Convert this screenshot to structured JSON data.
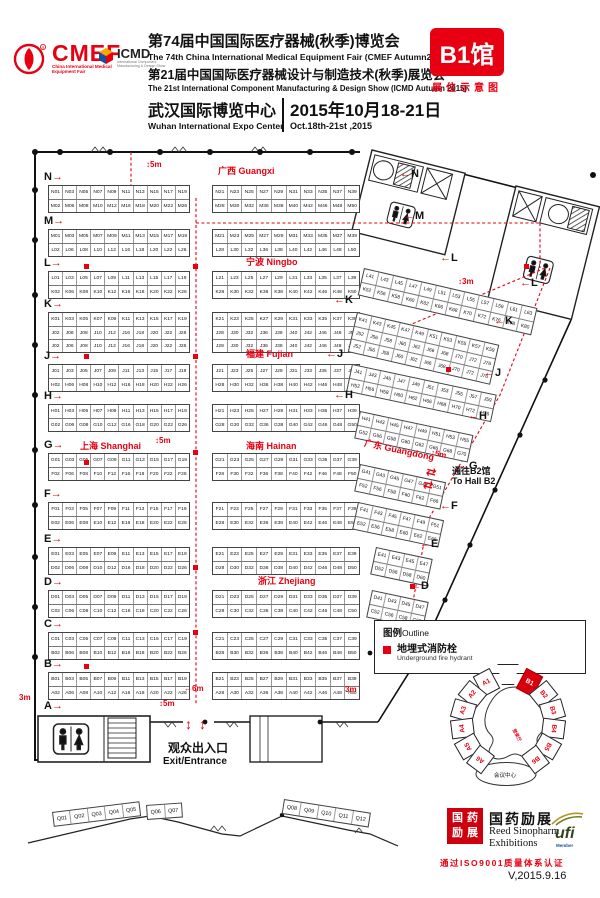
{
  "header": {
    "cmef": {
      "name": "CMEF",
      "tagline": "China International Medical Equipment Fair"
    },
    "icmd": {
      "name": "ICMD",
      "tagline": "International Component Manufacturing & Design Show"
    },
    "title_cn_1": "第74届中国国际医疗器械(秋季)博览会",
    "title_en_1": "The 74th China International Medical Equipment Fair (CMEF Autumn2015)",
    "title_cn_2": "第21届中国国际医疗器械设计与制造技术(秋季)展览会",
    "title_en_2": "The 21st International Component Manufacturing & Design Show (ICMD Autumn 2015)",
    "venue_cn": "武汉国际博览中心",
    "venue_en": "Wuhan International Expo Center",
    "date_cn": "2015年10月18-21日",
    "date_en": "Oct.18th-21st ,2015",
    "hall_badge": "B1馆",
    "hall_badge_sub": "展位示意图"
  },
  "plan": {
    "regions": {
      "guangxi": "广西 Guangxi",
      "ningbo": "宁波 Ningbo",
      "fujian": "福建 Fujian",
      "shanghai": "上海 Shanghai",
      "hainan": "海南 Hainan",
      "zhejiang": "浙江 Zhejiang",
      "guangdong": "广东 Guangdong"
    },
    "row_markers_left": [
      "N",
      "M",
      "L",
      "K",
      "J",
      "H",
      "G",
      "F",
      "E",
      "D",
      "C",
      "B",
      "A"
    ],
    "row_markers_right": [
      "N",
      "M",
      "L",
      "K",
      "J",
      "H"
    ],
    "row_markers_diag": [
      "L",
      "K",
      "J",
      "H",
      "G",
      "F",
      "E",
      "D",
      "C"
    ],
    "dims": [
      {
        "id": "d1",
        "text": "5m"
      },
      {
        "id": "d2",
        "text": "3m"
      },
      {
        "id": "d3",
        "text": "5m"
      },
      {
        "id": "d4",
        "text": "5m"
      },
      {
        "id": "d5",
        "text": "3m"
      },
      {
        "id": "d6",
        "text": "6m"
      },
      {
        "id": "d7",
        "text": "3m"
      },
      {
        "id": "d8",
        "text": "5m"
      },
      {
        "id": "d9",
        "text": "5m"
      }
    ],
    "exit": {
      "cn": "观众出入口",
      "en": "Exit/Entrance"
    },
    "to_b2": {
      "cn": "通往B2馆",
      "en": "To Hall B2"
    },
    "islands": {
      "nL": [
        [
          "N01",
          "N03",
          "N05",
          "N07",
          "N09",
          "N11",
          "N13",
          "N15",
          "N17",
          "N19"
        ],
        [
          "M02",
          "M06",
          "M08",
          "M10",
          "M12",
          "M16",
          "M18",
          "M20",
          "M22",
          "M26"
        ]
      ],
      "mL": [
        [
          "M01",
          "M03",
          "M05",
          "M07",
          "M09",
          "M11",
          "M13",
          "M15",
          "M17",
          "M19"
        ],
        [
          "L02",
          "L06",
          "L08",
          "L10",
          "L12",
          "L16",
          "L18",
          "L20",
          "L22",
          "L26"
        ]
      ],
      "lL": [
        [
          "L01",
          "L03",
          "L05",
          "L07",
          "L09",
          "L11",
          "L13",
          "L15",
          "L17",
          "L19"
        ],
        [
          "K02",
          "K06",
          "K08",
          "K10",
          "K12",
          "K16",
          "K18",
          "K20",
          "K22",
          "K26"
        ]
      ],
      "kL": [
        [
          "K01",
          "K03",
          "K05",
          "K07",
          "K09",
          "K11",
          "K13",
          "K15",
          "K17",
          "K19"
        ],
        [
          "J02",
          "J06",
          "J08",
          "J10",
          "J12",
          "J16",
          "J18",
          "J20",
          "J22",
          "J26"
        ],
        [
          "J02",
          "J06",
          "J08",
          "J10",
          "J12",
          "J16",
          "J18",
          "J20",
          "J22",
          "J26"
        ]
      ],
      "jL": [
        [
          "J01",
          "J03",
          "J05",
          "J07",
          "J09",
          "J11",
          "J13",
          "J15",
          "J17",
          "J19"
        ],
        [
          "H02",
          "H06",
          "H08",
          "H10",
          "H12",
          "H16",
          "H18",
          "H20",
          "H22",
          "H26"
        ]
      ],
      "hL": [
        [
          "H01",
          "H03",
          "H05",
          "H07",
          "H09",
          "H11",
          "H13",
          "H15",
          "H17",
          "H19"
        ],
        [
          "G02",
          "G06",
          "G08",
          "G10",
          "G12",
          "G16",
          "G18",
          "G20",
          "G22",
          "G26"
        ]
      ],
      "gL": [
        [
          "G01",
          "G03",
          "G05",
          "G07",
          "G09",
          "G11",
          "G13",
          "G15",
          "G17",
          "G19"
        ],
        [
          "F02",
          "F06",
          "F08",
          "F10",
          "F12",
          "F16",
          "F18",
          "F20",
          "F22",
          "F26"
        ]
      ],
      "fL": [
        [
          "F01",
          "F03",
          "F05",
          "F07",
          "F09",
          "F11",
          "F13",
          "F15",
          "F17",
          "F19"
        ],
        [
          "E02",
          "E06",
          "E08",
          "E10",
          "E12",
          "E16",
          "E18",
          "E20",
          "E22",
          "E26"
        ]
      ],
      "eL": [
        [
          "E01",
          "E03",
          "E05",
          "E07",
          "E09",
          "E11",
          "E13",
          "E15",
          "E17",
          "E19"
        ],
        [
          "D02",
          "D06",
          "D08",
          "D10",
          "D12",
          "D16",
          "D18",
          "D20",
          "D22",
          "D26"
        ]
      ],
      "dL": [
        [
          "D01",
          "D03",
          "D05",
          "D07",
          "D09",
          "D11",
          "D13",
          "D15",
          "D17",
          "D19"
        ],
        [
          "C02",
          "C06",
          "C08",
          "C10",
          "C12",
          "C16",
          "C18",
          "C20",
          "C22",
          "C26"
        ]
      ],
      "cL": [
        [
          "C01",
          "C03",
          "C05",
          "C07",
          "C09",
          "C11",
          "C13",
          "C15",
          "C17",
          "C19"
        ],
        [
          "B02",
          "B06",
          "B08",
          "B10",
          "B12",
          "B16",
          "B18",
          "B20",
          "B22",
          "B26"
        ]
      ],
      "bL": [
        [
          "B01",
          "B03",
          "B05",
          "B07",
          "B09",
          "B11",
          "B13",
          "B15",
          "B17",
          "B19"
        ],
        [
          "A02",
          "A06",
          "A08",
          "A10",
          "A12",
          "A16",
          "A18",
          "A20",
          "A22",
          "A26"
        ]
      ],
      "nR": [
        [
          "N21",
          "N23",
          "N25",
          "N27",
          "N29",
          "N31",
          "N33",
          "N35",
          "N37",
          "N39"
        ],
        [
          "M28",
          "M30",
          "M32",
          "M36",
          "M38",
          "M40",
          "M42",
          "M46",
          "M48",
          "M50"
        ]
      ],
      "mR": [
        [
          "M21",
          "M23",
          "M25",
          "M27",
          "M29",
          "M31",
          "M33",
          "M35",
          "M37",
          "M39"
        ],
        [
          "L28",
          "L30",
          "L32",
          "L36",
          "L38",
          "L40",
          "L42",
          "L46",
          "L48",
          "L50"
        ]
      ],
      "lR": [
        [
          "L21",
          "L23",
          "L25",
          "L27",
          "L29",
          "L31",
          "L33",
          "L35",
          "L37",
          "L39"
        ],
        [
          "K28",
          "K30",
          "K32",
          "K36",
          "K38",
          "K40",
          "K42",
          "K46",
          "K48",
          "K50"
        ]
      ],
      "kR": [
        [
          "K21",
          "K23",
          "K25",
          "K27",
          "K29",
          "K31",
          "K33",
          "K35",
          "K37",
          "K39"
        ],
        [
          "J28",
          "J30",
          "J32",
          "J36",
          "J38",
          "J40",
          "J42",
          "J46",
          "J48",
          "J50"
        ],
        [
          "J28",
          "J30",
          "J32",
          "J36",
          "J38",
          "J40",
          "J42",
          "J46",
          "J48",
          "J50"
        ]
      ],
      "jR": [
        [
          "J21",
          "J23",
          "J25",
          "J27",
          "J29",
          "J31",
          "J33",
          "J35",
          "J37",
          "J39"
        ],
        [
          "H28",
          "H30",
          "H32",
          "H36",
          "H38",
          "H40",
          "H42",
          "H46",
          "H48",
          "H50"
        ]
      ],
      "hR": [
        [
          "H21",
          "H23",
          "H25",
          "H27",
          "H29",
          "H31",
          "H33",
          "H35",
          "H37",
          "H39"
        ],
        [
          "G28",
          "G30",
          "G32",
          "G36",
          "G38",
          "G40",
          "G42",
          "G46",
          "G48",
          "G50"
        ]
      ],
      "gR": [
        [
          "G21",
          "G23",
          "G25",
          "G27",
          "G29",
          "G31",
          "G33",
          "G35",
          "G37",
          "G39"
        ],
        [
          "F28",
          "F30",
          "F32",
          "F36",
          "F38",
          "F40",
          "F42",
          "F46",
          "F48",
          "F50"
        ]
      ],
      "fR": [
        [
          "F21",
          "F23",
          "F25",
          "F27",
          "F29",
          "F31",
          "F33",
          "F35",
          "F37",
          "F39"
        ],
        [
          "E28",
          "E30",
          "E32",
          "E36",
          "E38",
          "E40",
          "E42",
          "E46",
          "E48",
          "E50"
        ]
      ],
      "eR": [
        [
          "E21",
          "E23",
          "E25",
          "E27",
          "E29",
          "E31",
          "E33",
          "E35",
          "E37",
          "E39"
        ],
        [
          "D28",
          "D30",
          "D32",
          "D36",
          "D38",
          "D40",
          "D42",
          "D46",
          "D48",
          "D50"
        ]
      ],
      "dR": [
        [
          "D21",
          "D23",
          "D25",
          "D27",
          "D29",
          "D31",
          "D33",
          "D35",
          "D37",
          "D39"
        ],
        [
          "C28",
          "C30",
          "C32",
          "C36",
          "C38",
          "C40",
          "C42",
          "C46",
          "C48",
          "C50"
        ]
      ],
      "cR": [
        [
          "C21",
          "C23",
          "C25",
          "C27",
          "C29",
          "C31",
          "C33",
          "C35",
          "C37",
          "C39"
        ],
        [
          "B28",
          "B30",
          "B32",
          "B36",
          "B38",
          "B40",
          "B42",
          "B46",
          "B48",
          "B50"
        ]
      ],
      "bR": [
        [
          "B21",
          "B23",
          "B25",
          "B27",
          "B29",
          "B31",
          "B33",
          "B35",
          "B37",
          "B39"
        ],
        [
          "A28",
          "A30",
          "A32",
          "A36",
          "A38",
          "A40",
          "A42",
          "A46",
          "A48",
          "A50"
        ]
      ],
      "lD": [
        [
          "L41",
          "L43",
          "L45",
          "L47",
          "L49",
          "L51",
          "L53",
          "L55",
          "L57",
          "L59",
          "L61",
          "L63"
        ],
        [
          "K52",
          "K56",
          "K58",
          "K60",
          "K62",
          "K66",
          "K68",
          "K70",
          "K72",
          "K76",
          "K78",
          "K80"
        ]
      ],
      "kD": [
        [
          "K41",
          "K43",
          "K45",
          "K47",
          "K49",
          "K51",
          "K53",
          "K55",
          "K57",
          "K59"
        ],
        [
          "J52",
          "J56",
          "J58",
          "J60",
          "J62",
          "J66",
          "J68",
          "J70",
          "J72",
          "J76"
        ],
        [
          "J52",
          "J56",
          "J58",
          "J60",
          "J62",
          "J66",
          "J68",
          "J70",
          "J72",
          "J76"
        ]
      ],
      "jD": [
        [
          "J41",
          "J43",
          "J45",
          "J47",
          "J49",
          "J51",
          "J53",
          "J55",
          "J57",
          "J59"
        ],
        [
          "H52",
          "H56",
          "H58",
          "H60",
          "H62",
          "H66",
          "H68",
          "H70",
          "H72",
          "H76"
        ]
      ],
      "hD": [
        [
          "H41",
          "H43",
          "H45",
          "H47",
          "H49",
          "H51",
          "H53",
          "H55"
        ],
        [
          "G52",
          "G56",
          "G58",
          "G60",
          "G62",
          "G66",
          "G68",
          "G70"
        ]
      ],
      "gD": [
        [
          "G41",
          "G43",
          "G45",
          "G47",
          "G49",
          "G51"
        ],
        [
          "F52",
          "F56",
          "F58",
          "F60",
          "F62",
          "F66"
        ]
      ],
      "fD": [
        [
          "F41",
          "F43",
          "F45",
          "F47",
          "F49",
          "F51"
        ],
        [
          "E52",
          "E56",
          "E58",
          "E60",
          "E62",
          "E66"
        ]
      ],
      "eD": [
        [
          "E41",
          "E43",
          "E45",
          "E47"
        ],
        [
          "D52",
          "D56",
          "D58",
          "D60"
        ]
      ],
      "dD": [
        [
          "D41",
          "D43",
          "D45",
          "D47"
        ],
        [
          "C52",
          "C56",
          "C58",
          "C60"
        ]
      ]
    },
    "q_groups": [
      [
        "Q01",
        "Q02",
        "Q03",
        "Q04",
        "Q05"
      ],
      [
        "Q06",
        "Q07"
      ],
      [
        "Q08",
        "Q09",
        "Q10",
        "Q11",
        "Q12"
      ]
    ]
  },
  "legend": {
    "title_cn": "图例",
    "title_en": "Outline",
    "item_cn": "地埋式消防栓",
    "item_en": "Underground fire hydrant"
  },
  "minimap": {
    "halls_left": [
      "A1",
      "A2",
      "A3",
      "A4",
      "A5",
      "A6"
    ],
    "halls_right": [
      "B1",
      "B2",
      "B3",
      "B4",
      "B5",
      "B6"
    ],
    "highlighted": "B1",
    "center_label": "登录厅",
    "conference_label": "会议中心"
  },
  "footer": {
    "sinopharm_seal": "国药励展",
    "sinopharm_cn": "国药励展",
    "sinopharm_en1": "Reed Sinopharm",
    "sinopharm_en2": "Exhibitions",
    "ufi": "ufi",
    "ufi_sub": "Member",
    "iso": "通过ISO9001质量体系认证",
    "version": "V,2015.9.16"
  },
  "colors": {
    "red": "#e60012",
    "hall_red": "#d8000f"
  }
}
